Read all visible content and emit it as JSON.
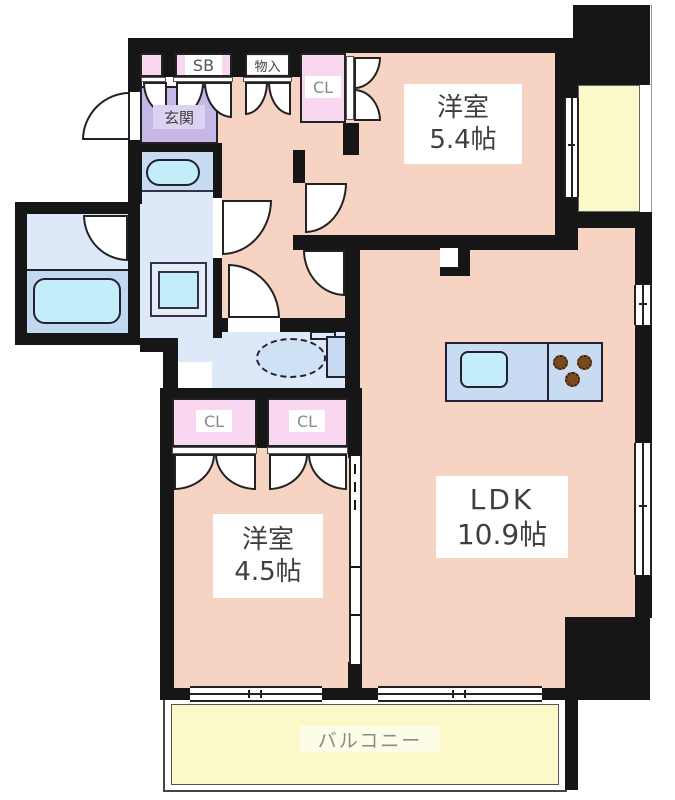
{
  "plan": {
    "room_54": {
      "name": "洋室",
      "size": "5.4帖"
    },
    "room_45": {
      "name": "洋室",
      "size": "4.5帖"
    },
    "ldk": {
      "name": "LDK",
      "size": "10.9帖"
    },
    "entrance_label": "玄関",
    "shoe_box_label": "SB",
    "storage_label": "物入",
    "closet_upper_label": "CL",
    "closet_left_label": "CL",
    "closet_right_label": "CL",
    "balcony_label": "バルコニー"
  },
  "colors": {
    "wall": "#161616",
    "room_floor_salmon": "#f7d3c3",
    "closet_pink": "#fad7f0",
    "entrance_purple": "#c6b7e6",
    "wet_area_blue": "#dde9f8",
    "kitchen_counter_blue": "#c7dcf2",
    "fixture_cyan": "#c2edf9",
    "balcony_yellow": "#fbf8c9",
    "burner_brown": "#7a4a20",
    "label_text": "#3f3f3f",
    "muted_text": "#8a8a8a"
  }
}
